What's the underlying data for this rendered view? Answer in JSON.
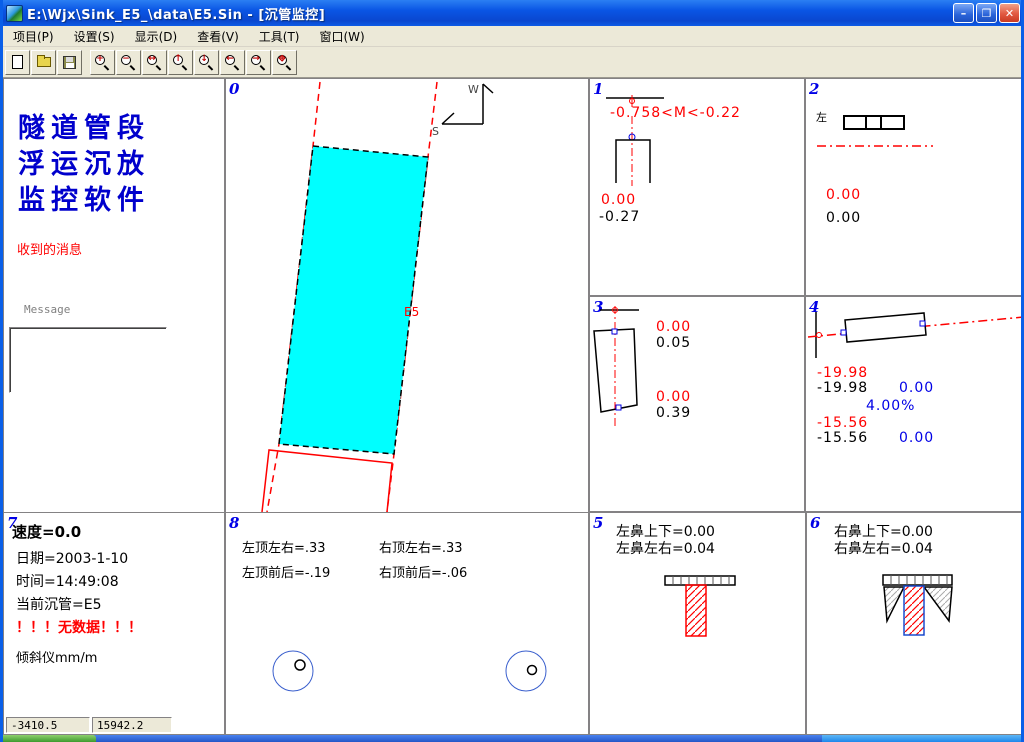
{
  "window": {
    "title": "E:\\Wjx\\Sink_E5_\\data\\E5.Sin - [沉管监控]",
    "controls": {
      "minimize": "–",
      "restore": "❐",
      "close": "✕"
    }
  },
  "menu": {
    "items": [
      "项目(P)",
      "设置(S)",
      "显示(D)",
      "查看(V)",
      "工具(T)",
      "窗口(W)"
    ]
  },
  "toolbar": {
    "icons": [
      "new-file-icon",
      "open-folder-icon",
      "save-floppy-icon",
      "zoom-in-icon",
      "zoom-out-icon",
      "zoom-width-icon",
      "zoom-up-icon",
      "zoom-down-icon",
      "zoom-left-icon",
      "zoom-right-icon",
      "zoom-all-icon"
    ]
  },
  "left_panel": {
    "app_title": "隧道管段\n浮运沉放\n监控软件",
    "received_label": "收到的消息",
    "message_label": "Message",
    "message_value": ""
  },
  "panel0": {
    "num": "0",
    "segment_label": "E5",
    "compass_up": "W",
    "compass_left": "S"
  },
  "panel1": {
    "num": "1",
    "range_text": "-0.758<M<-0.22",
    "value_red": "0.00",
    "value_black": "-0.27"
  },
  "panel2": {
    "num": "2",
    "side_label": "左",
    "value_red": "0.00",
    "value_black": "0.00"
  },
  "panel3": {
    "num": "3",
    "red_top": "0.00",
    "black_top": "0.05",
    "red_bottom": "0.00",
    "black_bottom": "0.39"
  },
  "panel4": {
    "num": "4",
    "red_top": "-19.98",
    "black_top": "-19.98",
    "blue_top": "0.00",
    "slope": "4.00%",
    "red_bottom": "-15.56",
    "black_bottom": "-15.56",
    "blue_bottom": "0.00"
  },
  "panel5": {
    "num": "5",
    "line1": "左鼻上下=0.00",
    "line2": "左鼻左右=0.04"
  },
  "panel6": {
    "num": "6",
    "line1": "右鼻上下=0.00",
    "line2": "右鼻左右=0.04"
  },
  "panel7": {
    "num": "7",
    "speed": "速度=0.0",
    "date": "日期=2003-1-10",
    "time": "时间=14:49:08",
    "current_segment": "当前沉管=E5",
    "no_data": "！！！无数据！！！",
    "inclinometer": "倾斜仪mm/m"
  },
  "panel8": {
    "num": "8",
    "top_left": "左顶左右=.33",
    "top_right": "右顶左右=.33",
    "bottom_left": "左顶前后=-.19",
    "bottom_right": "右顶前后=-.06"
  },
  "status": {
    "coord_x": "-3410.5",
    "coord_y": "15942.2"
  },
  "colors": {
    "titlebar_blue": "#0a55e4",
    "pipe_cyan": "#00ffff",
    "alert_red": "#ff0000",
    "label_blue": "#0000e6",
    "taskbar_blue": "#2456c7",
    "start_green": "#3c9a2e"
  }
}
